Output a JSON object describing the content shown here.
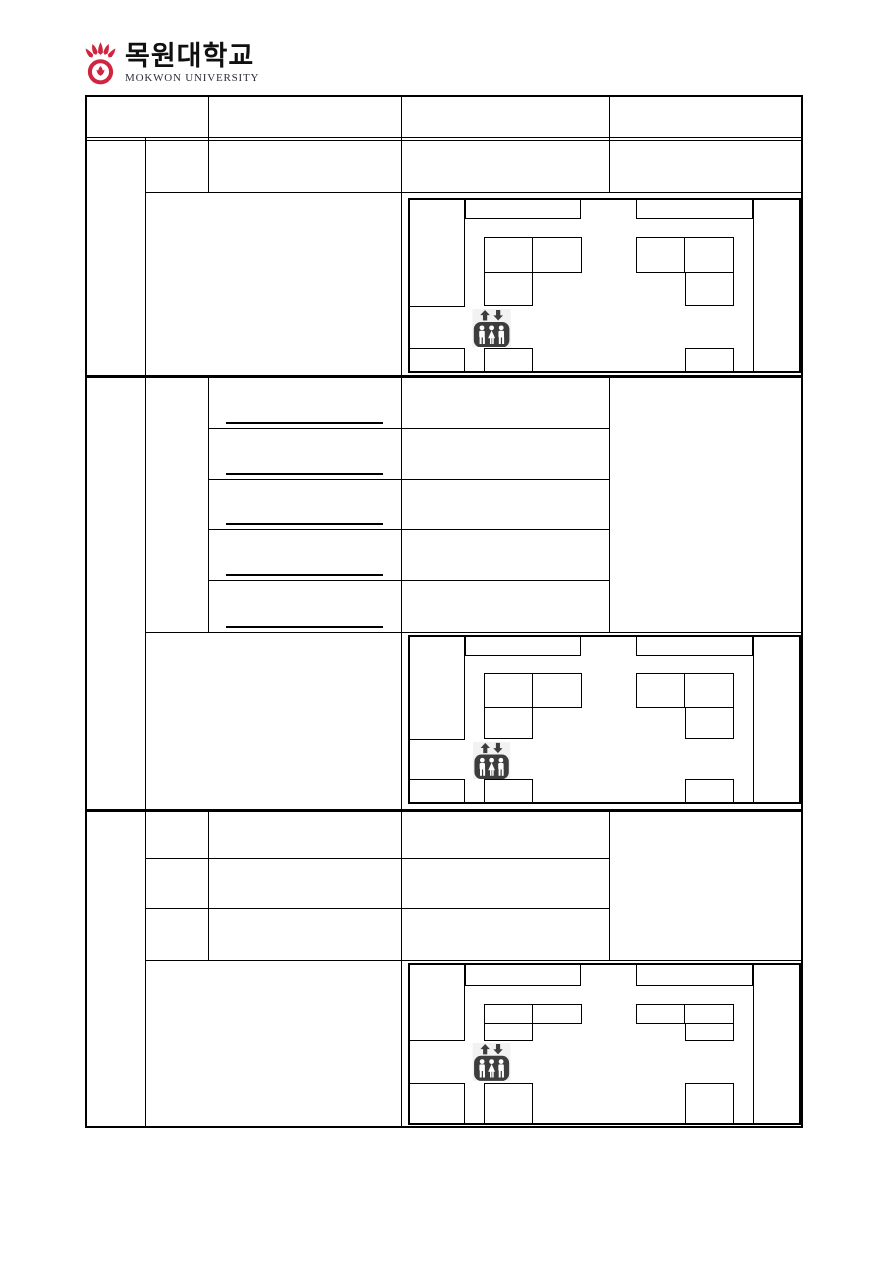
{
  "logo": {
    "university_name_ko": "목원대학교",
    "university_name_en": "MOKWON UNIVERSITY",
    "emblem_color": "#d02540"
  },
  "palette": {
    "line_color": "#000000",
    "elevator_icon_color": "#3d3d3d",
    "page_background": "#ffffff"
  },
  "form": {
    "header_columns": [
      "",
      "",
      "",
      ""
    ],
    "sections": [
      {
        "id": "section-1",
        "detail_rows": 1,
        "blank_underline_fields": 0,
        "has_floor_plan": true
      },
      {
        "id": "section-2",
        "detail_rows": 5,
        "blank_underline_fields": 5,
        "has_floor_plan": true
      },
      {
        "id": "section-3",
        "detail_rows": 3,
        "blank_underline_fields": 0,
        "has_floor_plan": true
      }
    ],
    "floor_plan_count": 3,
    "floor_plan_icon": "elevator-people-up-down-arrows"
  }
}
